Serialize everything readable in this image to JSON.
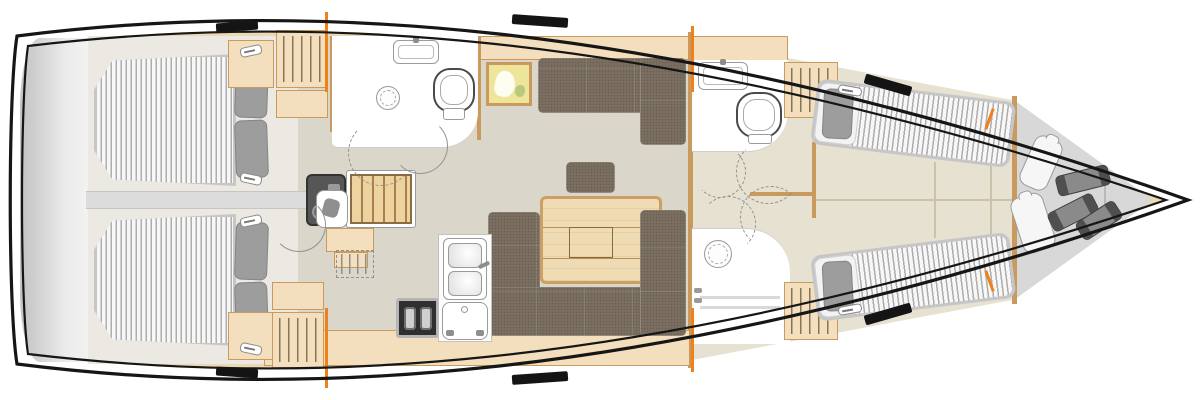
{
  "title": "Sailing yacht interior layout floor plan, top view, bow to the right",
  "diagram_type": "boat-floorplan",
  "palette": {
    "hull": "#161616",
    "deck": "#ecd8b2",
    "floor": "#dbd6ca",
    "cabinfloor": "#ece9e2",
    "forefloor": "#e7e1d2",
    "wood": "#f3dfbd",
    "woodBorder": "#c89a5e",
    "hanger": "#8a7456",
    "settee": "#7a6f60",
    "pillow": "#9d9d9d",
    "platform": "#cfcfcf",
    "accent": "#f08018",
    "engine": "#565656",
    "stove": "#2f2f2f",
    "chart": "#eee49a",
    "fix": "#9b9b9b"
  },
  "rooms": [
    {
      "id": "stern",
      "name": "Transom / swim platform",
      "fixtures": [
        "swim-platform"
      ]
    },
    {
      "id": "aft-cabin-port",
      "name": "Aft cabin (port)",
      "fixtures": [
        "double-berth",
        "pillows-x2",
        "hanging-locker",
        "cabinets",
        "door-handles"
      ]
    },
    {
      "id": "aft-cabin-starboard",
      "name": "Aft cabin (starboard)",
      "fixtures": [
        "double-berth",
        "pillows-x2",
        "hanging-locker",
        "cabinets",
        "door-handles"
      ]
    },
    {
      "id": "companionway",
      "name": "Companionway",
      "fixtures": [
        "steps",
        "engine-compartment",
        "nav-seat",
        "lower-steps",
        "optional-wet-locker"
      ]
    },
    {
      "id": "head-aft",
      "name": "Aft head with shower",
      "fixtures": [
        "washbasin",
        "toilet",
        "shower-drain",
        "door-swings"
      ]
    },
    {
      "id": "salon",
      "name": "Salon",
      "fixtures": [
        "l-settee",
        "stool",
        "folding-table",
        "u-settee",
        "wall-chart-art",
        "top-lockers"
      ]
    },
    {
      "id": "galley",
      "name": "Galley",
      "fixtures": [
        "two-burner-stove",
        "double-sink-with-faucet",
        "top-loading-fridge",
        "counters",
        "hanging-locker"
      ]
    },
    {
      "id": "head-forward",
      "name": "Forward head",
      "fixtures": [
        "washbasin",
        "toilet",
        "door-swings"
      ]
    },
    {
      "id": "shower-forward",
      "name": "Forward shower stall",
      "fixtures": [
        "molded-seat",
        "drain",
        "door-swings"
      ]
    },
    {
      "id": "forward-cabin",
      "name": "Forward cabin",
      "fixtures": [
        "v-berth-port",
        "v-berth-starboard",
        "pillows",
        "hanging-lockers",
        "center-aisle"
      ]
    },
    {
      "id": "bow",
      "name": "Bow / anchor & fender locker",
      "fixtures": [
        "fender-x2",
        "rolled-fender-x3",
        "bulkhead"
      ]
    }
  ],
  "markers": {
    "deck_hatches": 6,
    "bulkhead_ticks_color": "#f08018",
    "bulkhead_ticks_positions": [
      "x327-top",
      "x327-bottom",
      "x692-top",
      "x692-bottom",
      "x990-top",
      "x990-bottom"
    ],
    "door_swing_style": "dashed-quarter-arc"
  }
}
